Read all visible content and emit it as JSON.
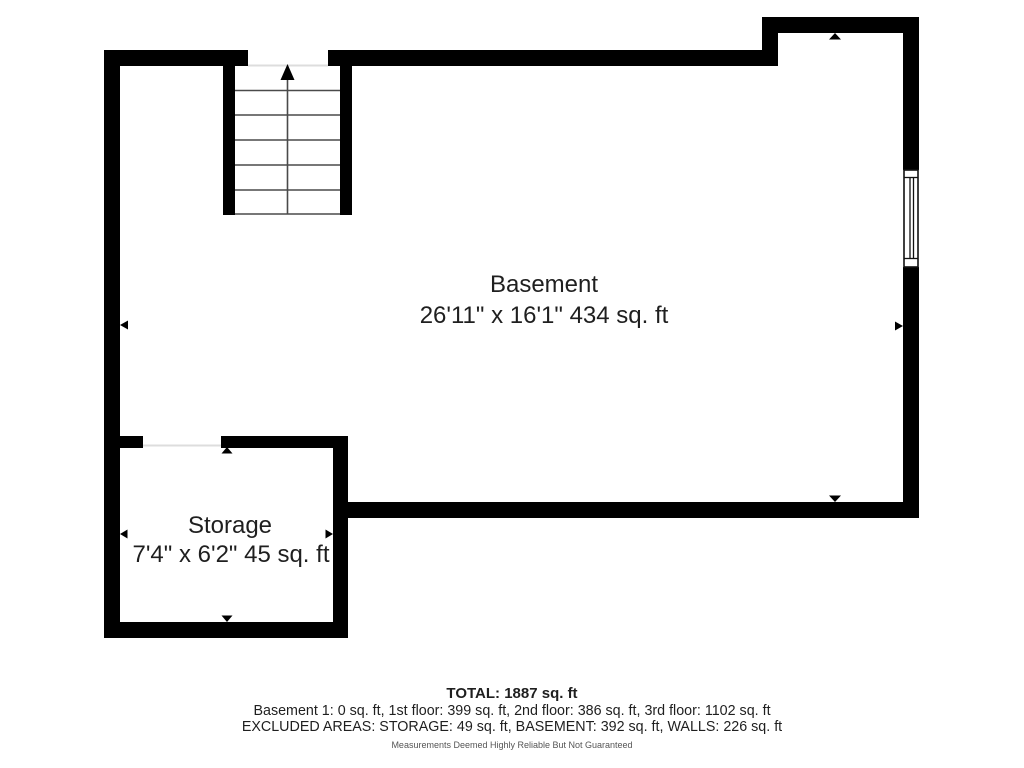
{
  "rooms": {
    "basement": {
      "name": "Basement",
      "dims": "26'11\" x 16'1\" 434 sq. ft"
    },
    "storage": {
      "name": "Storage",
      "dims": "7'4\" x 6'2\" 45 sq. ft"
    }
  },
  "stairs": {
    "direction_icon": "up-arrow",
    "tread_count": 6
  },
  "icons": {
    "window": "double-pane-window",
    "dimension_markers": [
      "left-arrow",
      "right-arrow",
      "up-arrow",
      "down-arrow"
    ]
  },
  "footer": {
    "total": "TOTAL: 1887 sq. ft",
    "floors": "Basement 1: 0 sq. ft, 1st floor: 399 sq. ft, 2nd floor: 386 sq. ft, 3rd floor: 1102 sq. ft",
    "excluded": "EXCLUDED AREAS: STORAGE: 49 sq. ft, BASEMENT: 392 sq. ft, WALLS: 226 sq. ft",
    "disclaimer": "Measurements Deemed Highly Reliable But Not Guaranteed"
  },
  "colors": {
    "wall": "#000000",
    "text": "#1f1f1f",
    "stair_line": "#4a4a4a",
    "threshold": "#dddddd",
    "disclaimer": "#555555"
  }
}
